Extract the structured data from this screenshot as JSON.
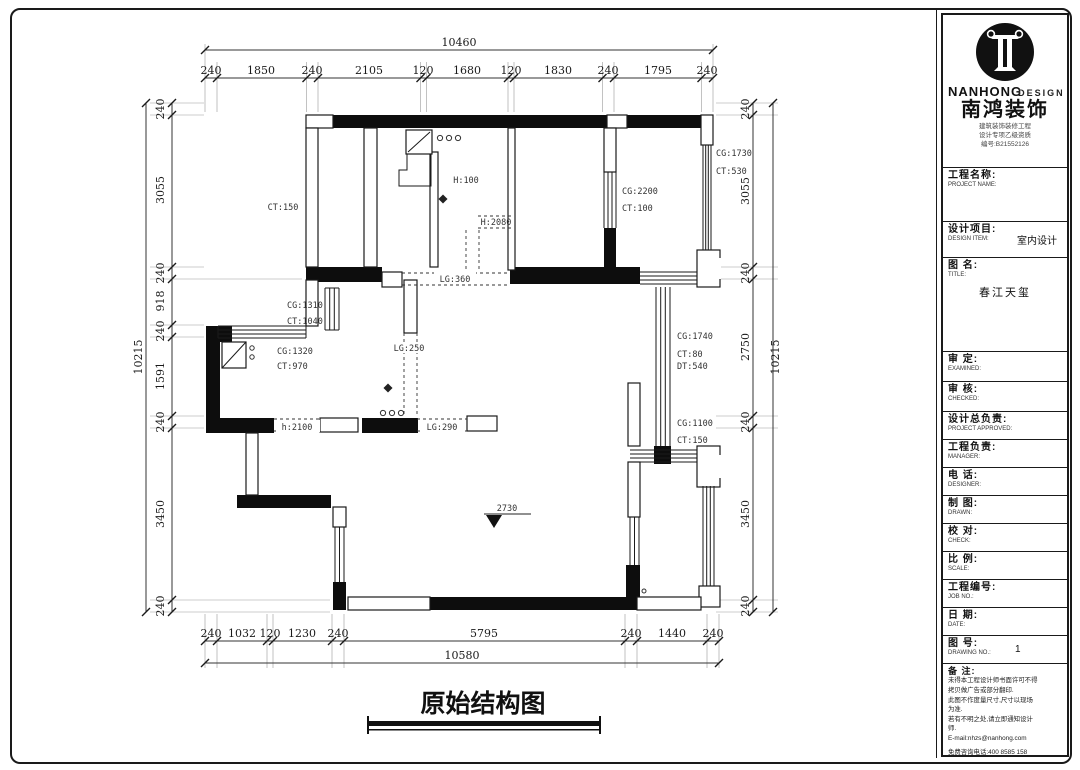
{
  "drawing_title": "原始结构图",
  "level_mark": "2730",
  "dims": {
    "top": {
      "total": "10460",
      "segs": [
        "240",
        "1850",
        "240",
        "2105",
        "120",
        "1680",
        "120",
        "1830",
        "240",
        "1795",
        "240"
      ]
    },
    "left": {
      "total": "10215",
      "segs": [
        "240",
        "3055",
        "240",
        "918",
        "240",
        "1591",
        "240",
        "3450",
        "240"
      ]
    },
    "right": {
      "total": "10215",
      "segs": [
        "240",
        "3055",
        "240",
        "2750",
        "240",
        "3450",
        "240"
      ]
    },
    "bottom": {
      "total": "10580",
      "segs": [
        "240",
        "1032",
        "120",
        "1230",
        "240",
        "5795",
        "240",
        "1440",
        "240"
      ]
    }
  },
  "labels": {
    "ct150": "CT:150",
    "h100": "H:100",
    "h2080": "H:2080",
    "cg2200": "CG:2200",
    "ct100": "CT:100",
    "cg1730": "CG:1730",
    "ct530": "CT:530",
    "cg1310": "CG:1310",
    "ct1040": "CT:1040",
    "cg1320": "CG:1320",
    "ct970": "CT:970",
    "lg250": "LG:250",
    "lg360": "LG:360",
    "h2100": "h:2100",
    "lg290": "LG:290",
    "cg1740": "CG:1740",
    "ct80": "CT:80",
    "dt540": "DT:540",
    "cg1100": "CG:1100",
    "ct150b": "CT:150"
  },
  "titleblock": {
    "brand_en": "NANHONG",
    "brand_en2": "DESIGN",
    "brand_cn": "南鸿装饰",
    "cert1": "建筑装饰装修工程",
    "cert2": "设计专项乙级资质",
    "cert3": "编号:B21552126",
    "project_name": {
      "cn": "工程名称:",
      "en": "PROJECT NAME:"
    },
    "design_item": {
      "cn": "设计项目:",
      "en": "DESIGN ITEM:",
      "value": "室内设计"
    },
    "map_title": {
      "cn": "图 名:",
      "en": "TITLE:",
      "value": "春江天玺"
    },
    "examined": {
      "cn": "审  定:",
      "en": "EXAMINED:"
    },
    "checked": {
      "cn": "审  核:",
      "en": "CHECKED:"
    },
    "approved": {
      "cn": "设计总负责:",
      "en": "PROJECT APPROVED:"
    },
    "manager": {
      "cn": "工程负责:",
      "en": "MANAGER:"
    },
    "phone": {
      "cn": "电  话:",
      "en": "DESIGNER:"
    },
    "drawn": {
      "cn": "制  图:",
      "en": "DRAWN:"
    },
    "check": {
      "cn": "校  对:",
      "en": "CHECK:"
    },
    "scale": {
      "cn": "比  例:",
      "en": "SCALE:"
    },
    "job_no": {
      "cn": "工程编号:",
      "en": "JOB NO.:"
    },
    "date": {
      "cn": "日  期:",
      "en": "DATE:"
    },
    "drawing_no": {
      "cn": "图  号:",
      "en": "DRAWING NO.:",
      "value": "1"
    },
    "notes": {
      "cn": "备 注:",
      "lines": [
        "未得本工程设计师书面许可不得",
        "拷贝做广告或部分翻印.",
        "此图不作度量尺寸,尺寸以现场",
        "为准.",
        "若有不明之处,请立即通知设计",
        "师.",
        "E-mail:nhzs@nanhong.com",
        "免费咨询电话:400 8585 158"
      ]
    }
  }
}
